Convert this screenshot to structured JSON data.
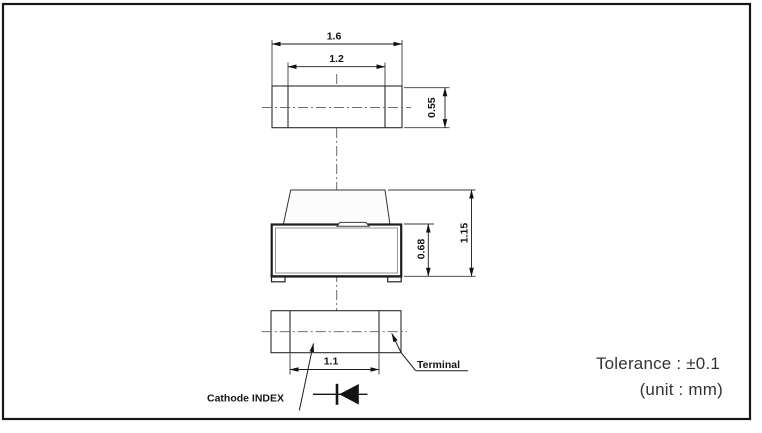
{
  "drawing": {
    "type": "SMD LED package outline drawing",
    "colors": {
      "line": "#1a1a1a",
      "background": "#ffffff"
    },
    "top_view": {
      "dim_outer_width": "1.6",
      "dim_inner_width": "1.2",
      "dim_depth": "0.55"
    },
    "front_view": {
      "dim_body_height": "0.68",
      "dim_total_height": "1.15"
    },
    "bottom_view": {
      "dim_terminal_span": "1.1",
      "cathode_label": "Cathode INDEX",
      "terminal_label": "Terminal"
    },
    "notes": {
      "tolerance": "Tolerance : ±0.1",
      "unit": "(unit : mm)"
    }
  }
}
